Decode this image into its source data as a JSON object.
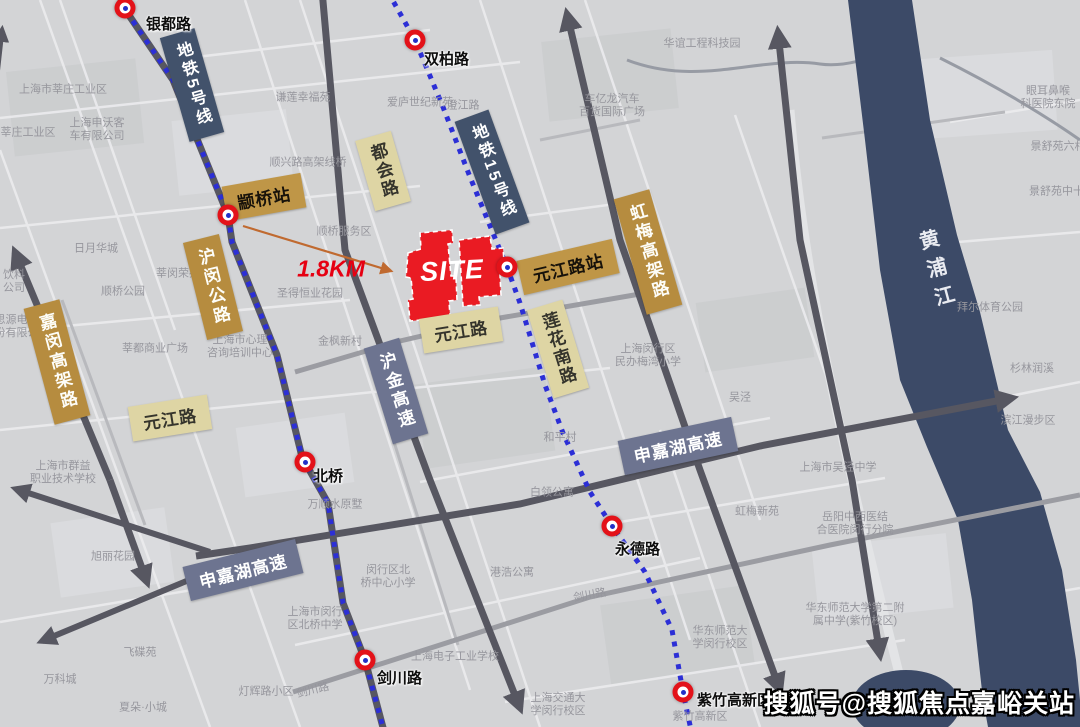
{
  "colors": {
    "map_bg": "#d3d4d6",
    "road_dark": "#575761",
    "road_medium": "#9b9ca2",
    "river_navy": "#3c4a67",
    "metro_dot_blue": "#2c2fd6",
    "station_ring_red": "#e31219",
    "station_dot_blue": "#2230c8",
    "metro_label_navy": "#42526b",
    "road_label_gold": "#b68c3f",
    "station_label_gold": "#bf9647",
    "road_label_beige": "#ded5a4",
    "highway_label_slate": "#6d7490",
    "site_red": "#ea1b23",
    "distance_red": "#e60012",
    "arrow_orange": "#c06a30"
  },
  "site": {
    "label": "SITE",
    "distance_label": "1.8KM"
  },
  "river": {
    "name": "黄浦江"
  },
  "watermark": {
    "text": "搜狐号@搜狐焦点嘉峪关站"
  },
  "stations": [
    {
      "name": "银都路"
    },
    {
      "name": "双柏路"
    },
    {
      "name": "颛桥站"
    },
    {
      "name": "元江路站"
    },
    {
      "name": "北桥"
    },
    {
      "name": "永德路"
    },
    {
      "name": "剑川路"
    },
    {
      "name": "紫竹高新区"
    }
  ],
  "boxed_labels": [
    {
      "text": "地铁5号线",
      "style": "metro-line"
    },
    {
      "text": "地铁15号线",
      "style": "metro-line"
    },
    {
      "text": "虹梅高架路",
      "style": "elevated-road"
    },
    {
      "text": "沪闵公路",
      "style": "elevated-road"
    },
    {
      "text": "嘉闵高架路",
      "style": "elevated-road"
    },
    {
      "text": "都会路",
      "style": "road"
    },
    {
      "text": "莲花南路",
      "style": "road"
    },
    {
      "text": "元江路",
      "style": "road"
    },
    {
      "text": "元江路",
      "style": "road"
    },
    {
      "text": "沪金高速",
      "style": "highway"
    },
    {
      "text": "申嘉湖高速",
      "style": "highway"
    },
    {
      "text": "申嘉湖高速",
      "style": "highway"
    }
  ],
  "bg_labels": [
    {
      "text": "上海市莘庄工业区",
      "x": 63,
      "y": 90
    },
    {
      "text": "上海申沃客\n车有限公司",
      "x": 97,
      "y": 130
    },
    {
      "text": "莘庄工业区",
      "x": 28,
      "y": 133
    },
    {
      "text": "谦莲幸福苑",
      "x": 303,
      "y": 98
    },
    {
      "text": "爱庐世纪新苑",
      "x": 420,
      "y": 103
    },
    {
      "text": "澄江路",
      "x": 463,
      "y": 106
    },
    {
      "text": "车亿龙汽车\n百货国际广场",
      "x": 612,
      "y": 106
    },
    {
      "text": "华谊工程科技园",
      "x": 702,
      "y": 44
    },
    {
      "text": "顺兴路高架线桥",
      "x": 308,
      "y": 163
    },
    {
      "text": "顺桥服务区",
      "x": 344,
      "y": 232
    },
    {
      "text": "日月华城",
      "x": 96,
      "y": 249
    },
    {
      "text": "饮料\n公司",
      "x": 14,
      "y": 282
    },
    {
      "text": "思源电力股\n份有限公司",
      "x": 22,
      "y": 327
    },
    {
      "text": "莘闵荣苑",
      "x": 178,
      "y": 274
    },
    {
      "text": "顺桥公园",
      "x": 123,
      "y": 292
    },
    {
      "text": "莘都商业广场",
      "x": 155,
      "y": 349
    },
    {
      "text": "上海市心理\n咨询培训中心",
      "x": 240,
      "y": 347
    },
    {
      "text": "圣得恒业花园",
      "x": 310,
      "y": 294
    },
    {
      "text": "金枫新村",
      "x": 340,
      "y": 342
    },
    {
      "text": "上海市群益\n职业技术学校",
      "x": 63,
      "y": 473
    },
    {
      "text": "万顺水原墅",
      "x": 335,
      "y": 505
    },
    {
      "text": "旭丽花园",
      "x": 113,
      "y": 557
    },
    {
      "text": "飞碟苑",
      "x": 140,
      "y": 653
    },
    {
      "text": "万科城",
      "x": 60,
      "y": 680
    },
    {
      "text": "夏朵·小城",
      "x": 143,
      "y": 708
    },
    {
      "text": "灯辉路小区",
      "x": 266,
      "y": 692
    },
    {
      "text": "剑川路",
      "x": 313,
      "y": 691,
      "rot": -14
    },
    {
      "text": "剑川路",
      "x": 590,
      "y": 596,
      "rot": -10
    },
    {
      "text": "上海市闵行\n区北桥中学",
      "x": 315,
      "y": 619
    },
    {
      "text": "闵行区北\n桥中心小学",
      "x": 388,
      "y": 577
    },
    {
      "text": "港浩公寓",
      "x": 512,
      "y": 573
    },
    {
      "text": "上海电子工业学校",
      "x": 455,
      "y": 657
    },
    {
      "text": "上海交通大\n学闵行校区",
      "x": 558,
      "y": 705
    },
    {
      "text": "紫竹高新区",
      "x": 700,
      "y": 717
    },
    {
      "text": "虹梅新苑",
      "x": 757,
      "y": 512
    },
    {
      "text": "岳阳中西医结\n合医院闵行分院",
      "x": 855,
      "y": 524
    },
    {
      "text": "华东师范大学第二附\n属中学(紫竹校区)",
      "x": 855,
      "y": 615
    },
    {
      "text": "华东师范大\n学闵行校区",
      "x": 720,
      "y": 638
    },
    {
      "text": "上海闵行区\n民办梅湾小学",
      "x": 648,
      "y": 356
    },
    {
      "text": "和平村",
      "x": 560,
      "y": 438
    },
    {
      "text": "白领公寓",
      "x": 552,
      "y": 493
    },
    {
      "text": "吴泾",
      "x": 740,
      "y": 398
    },
    {
      "text": "上海市吴泾中学",
      "x": 838,
      "y": 468
    },
    {
      "text": "眼耳鼻喉\n科医院东院",
      "x": 1048,
      "y": 98
    },
    {
      "text": "景舒苑六村",
      "x": 1058,
      "y": 147
    },
    {
      "text": "景舒苑中十村",
      "x": 1062,
      "y": 192
    },
    {
      "text": "拜尔体育公园",
      "x": 990,
      "y": 308
    },
    {
      "text": "杉林润溪",
      "x": 1032,
      "y": 369
    },
    {
      "text": "滨江漫步区",
      "x": 1028,
      "y": 421
    }
  ]
}
